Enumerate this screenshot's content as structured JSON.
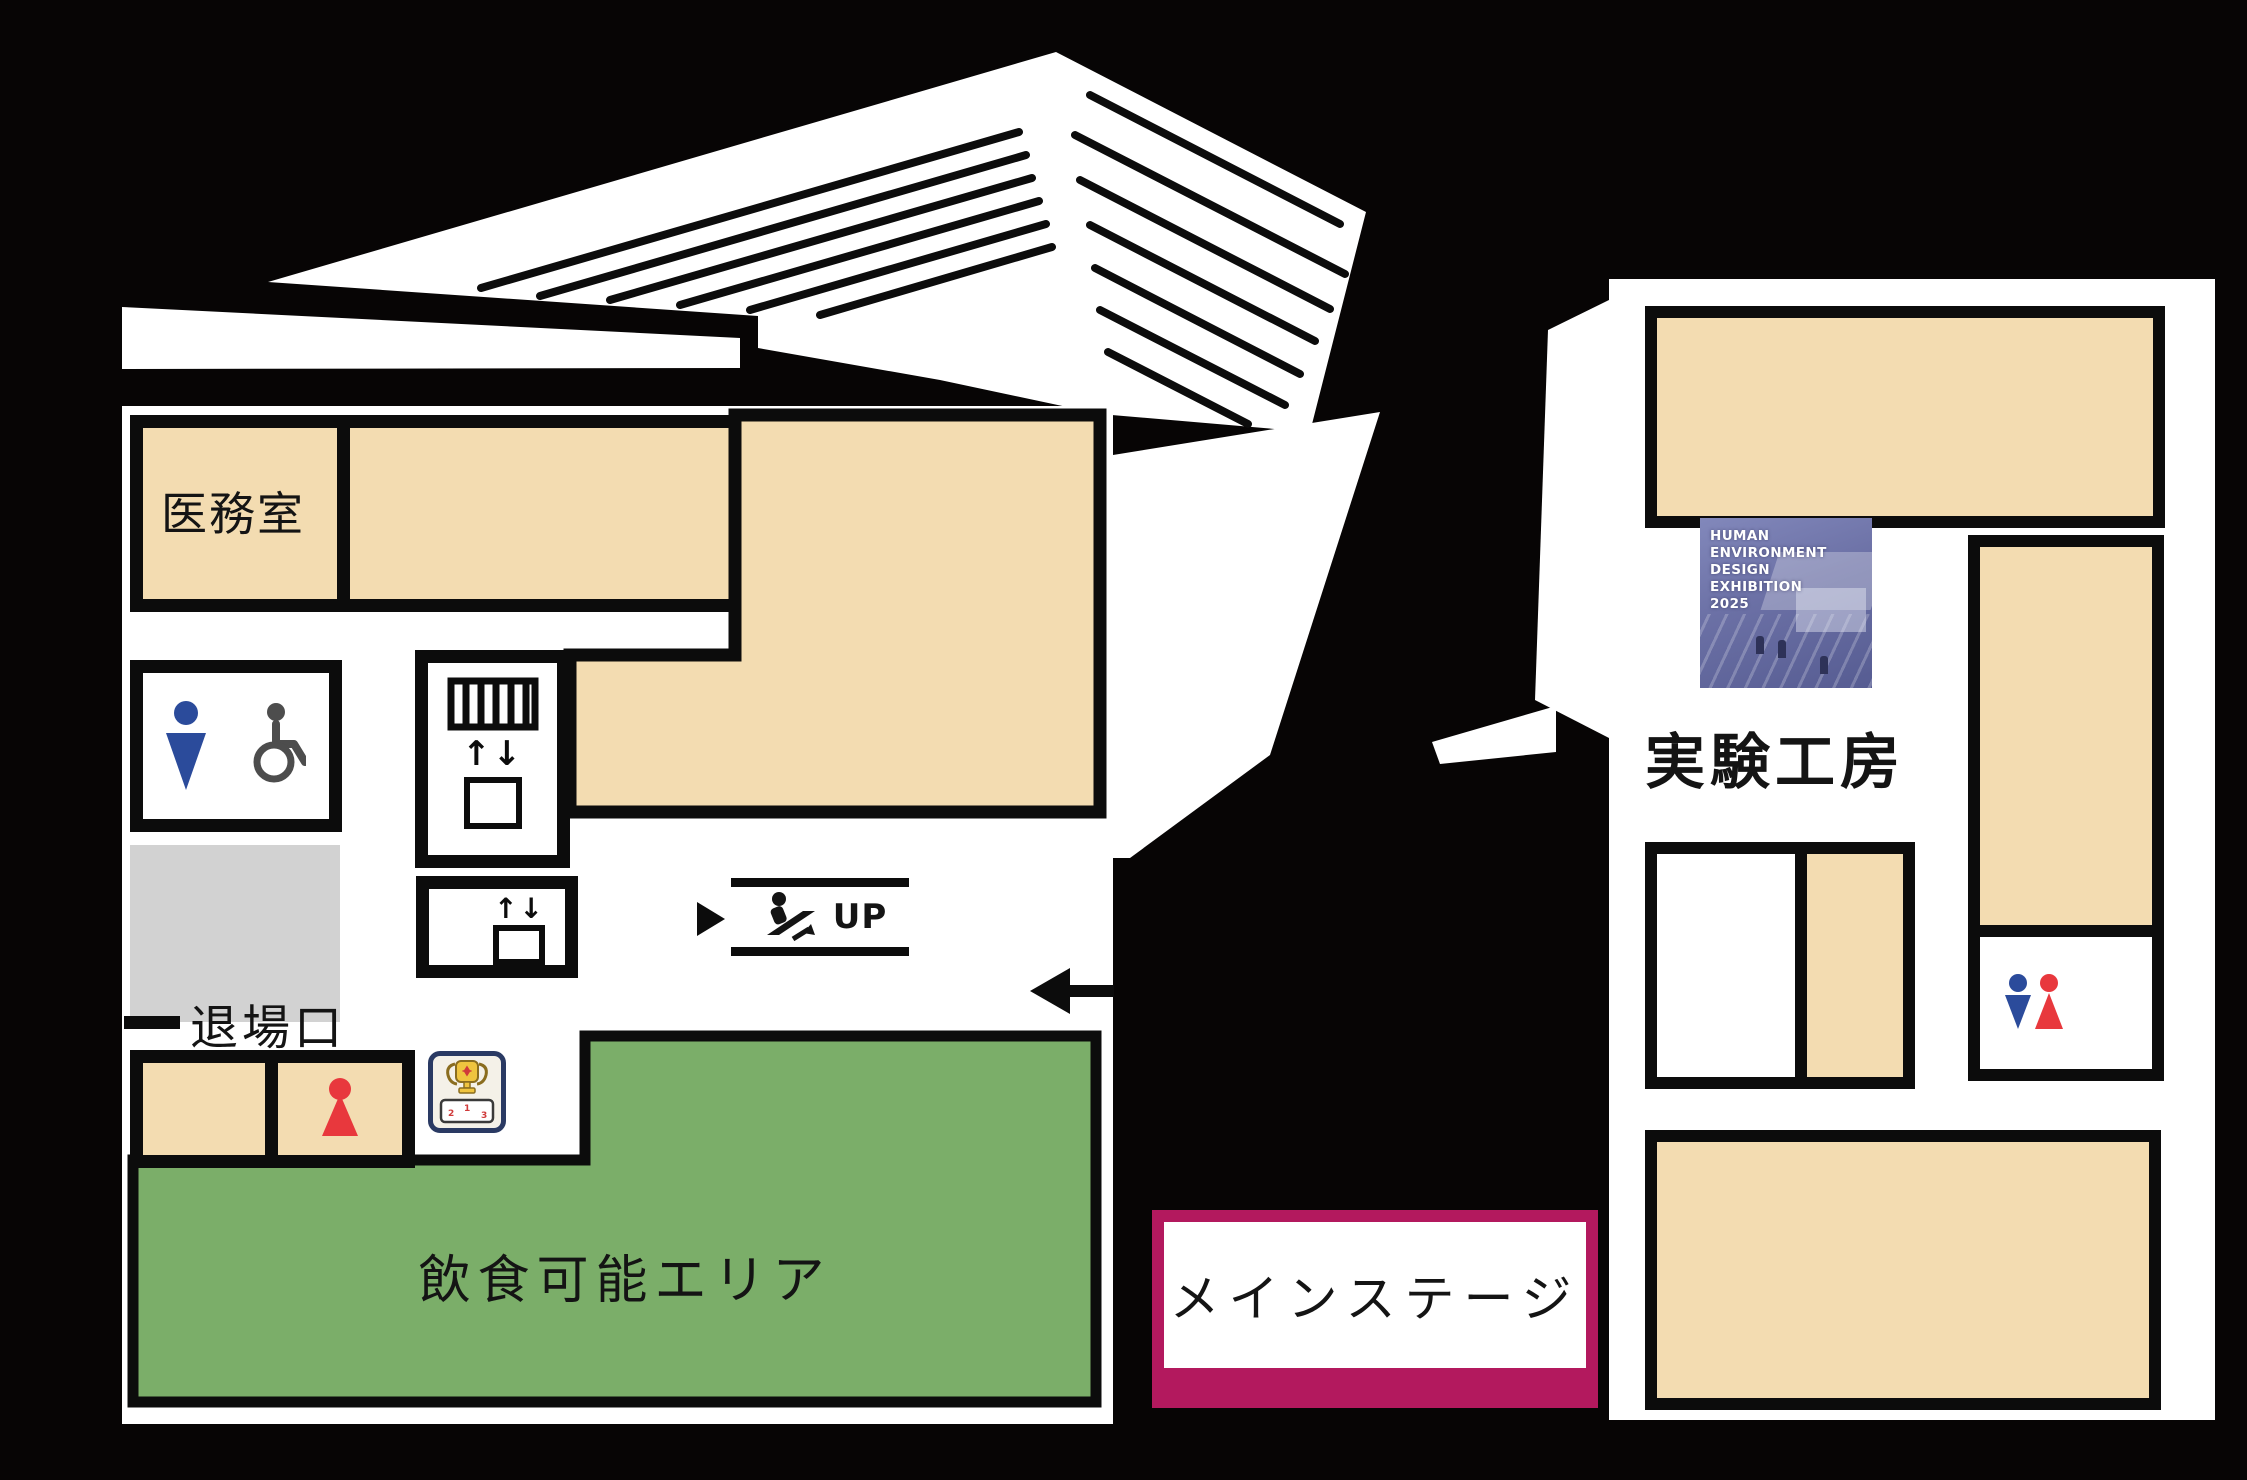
{
  "labels": {
    "medical_room": "医務室",
    "exit": "退場口",
    "food_area": "飲食可能エリア",
    "main_stage": "メインステージ",
    "workshop": "実験工房",
    "escalator_up": "UP"
  },
  "poster": {
    "line1": "HUMAN",
    "line2": "ENVIRONMENT",
    "line3": "DESIGN",
    "line4": "EXHIBITION",
    "line5": "2025"
  },
  "podium": {
    "first": "1",
    "second": "2",
    "third": "3"
  },
  "icons": {
    "elevator_arrows": "↑↓"
  },
  "colors": {
    "background": "#070505",
    "room_tan": "#F3DCB1",
    "food_green": "#7BAE69",
    "gray_room": "#D2D2D2",
    "stage_frame": "#B3195E",
    "mens_blue": "#2B4B9B",
    "womens_red": "#E8383D",
    "wall_black": "#0c0c0c"
  }
}
